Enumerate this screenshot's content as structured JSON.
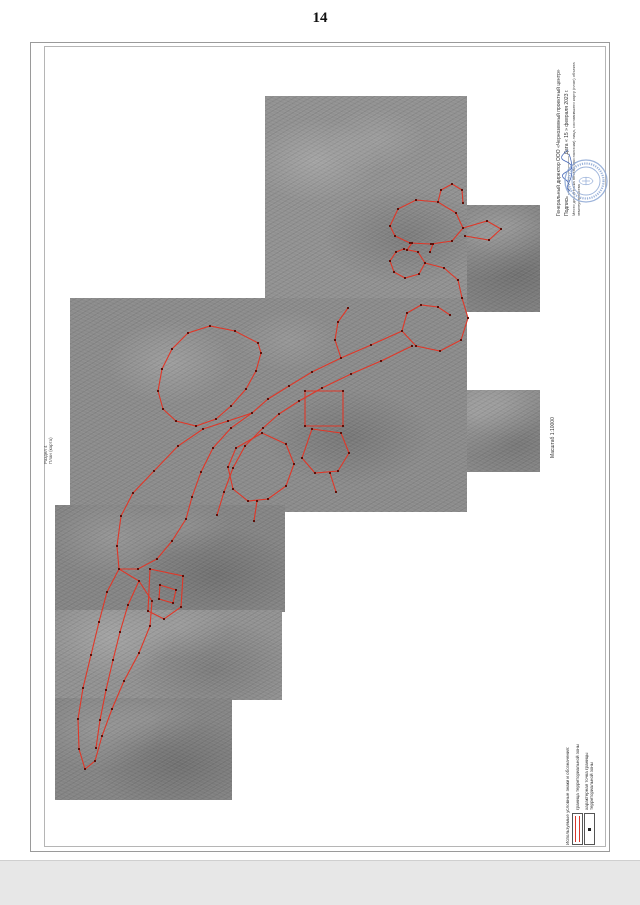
{
  "page_number": "14",
  "section_label": {
    "line1": "Раздел 4",
    "line2": "План (карта)"
  },
  "map": {
    "scale_label": "Масштаб 1:10000"
  },
  "title_block": {
    "line1": "Генеральный директор ООО «Черноземный проектный центр»",
    "line2": "Подпись ______________  Дата « 15 »  февраля  2023 г.",
    "line3": "Место для оттиска печати (при наличии) лица, составившего карту (план) объекта землеустройства"
  },
  "legend": {
    "header": "Используемые условные знаки и обозначения:",
    "items": [
      {
        "symbol": "boundary-line",
        "label": "граница территориальной зоны"
      },
      {
        "symbol": "turning-point",
        "label": "характерная точка границы территориальной зоны"
      }
    ]
  },
  "colors": {
    "boundary_line": "#e03728",
    "boundary_point": "#5e0f08",
    "stamp_blue": "#8ba6d4",
    "photo_gray": "#8b8b8b"
  }
}
